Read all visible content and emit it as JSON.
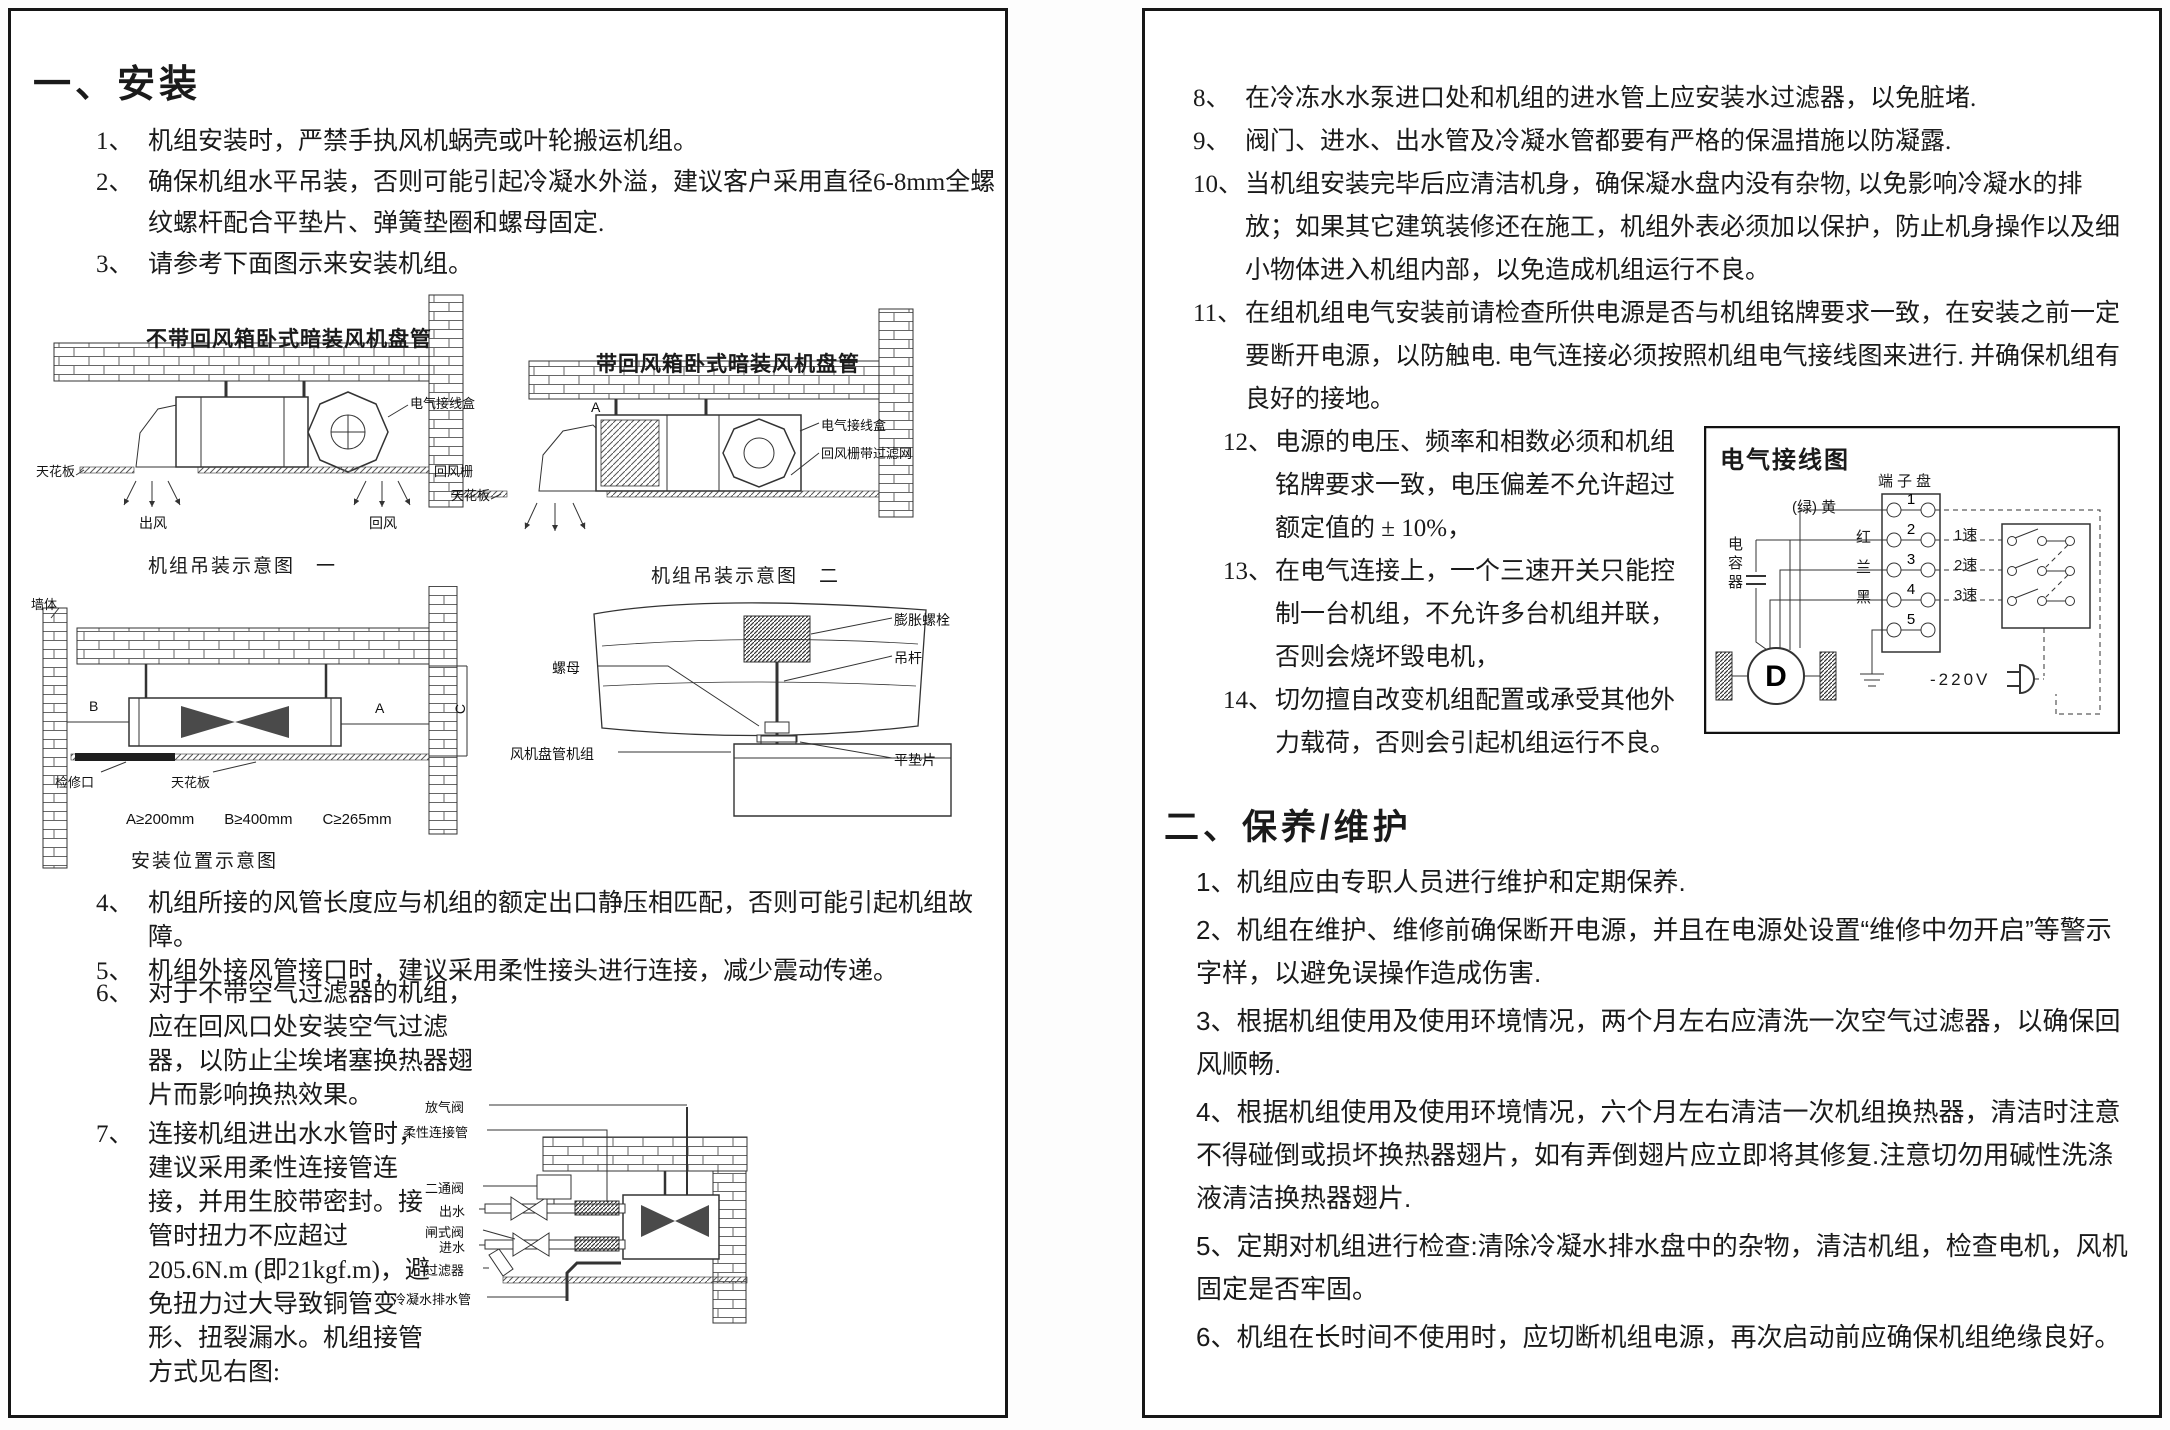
{
  "install": {
    "title": "一、安装",
    "items": [
      {
        "num": "1、",
        "text": "机组安装时，严禁手执风机蜗壳或叶轮搬运机组。"
      },
      {
        "num": "2、",
        "text": "确保机组水平吊装，否则可能引起冷凝水外溢，建议客户采用直径6-8mm全螺纹螺杆配合平垫片、弹簧垫圈和螺母固定."
      },
      {
        "num": "3、",
        "text": "请参考下面图示来安装机组。"
      },
      {
        "num": "4、",
        "text": "机组所接的风管长度应与机组的额定出口静压相匹配，否则可能引起机组故障。"
      },
      {
        "num": "5、",
        "text": "机组外接风管接口时，建议采用柔性接头进行连接，减少震动传递。"
      },
      {
        "num": "6、",
        "text": "对于不带空气过滤器的机组，应在回风口处安装空气过滤器，以防止尘埃堵塞换热器翅片而影响换热效果。"
      },
      {
        "num": "7、",
        "text": "连接机组进出水水管时，建议采用柔性连接管连接，并用生胶带密封。接管时扭力不应超过205.6N.m (即21kgf.m)，避免扭力过大导致铜管变形、扭裂漏水。机组接管方式见右图:"
      }
    ]
  },
  "hang1": {
    "title": "不带回风箱卧式暗装风机盘管",
    "caption": "机组吊装示意图　一",
    "junction_box": "电气接线盒",
    "ceiling": "天花板",
    "return_grille": "回风栅",
    "supply_air": "出风",
    "return_air": "回风"
  },
  "hang2": {
    "title": "带回风箱卧式暗装风机盘管",
    "caption": "机组吊装示意图　二",
    "dim_a": "A",
    "junction_box": "电气接线盒",
    "return_filter": "回风栅带过滤网",
    "ceiling": "天花板"
  },
  "position": {
    "caption": "安装位置示意图",
    "wall": "墙体",
    "dim_a": "A",
    "dim_b": "B",
    "dim_c": "C",
    "access": "检修口",
    "ceiling": "天花板",
    "dims": "A≥200mm　　B≥400mm　　C≥265mm"
  },
  "hanger": {
    "nut": "螺母",
    "unit": "风机盘管机组",
    "anchor_bolt": "膨胀螺栓",
    "rod": "吊杆",
    "washer": "平垫片"
  },
  "piping": {
    "air_vent": "放气阀",
    "flex": "柔性连接管",
    "valve2": "二通阀",
    "out": "出水",
    "gate": "闸式阀",
    "in": "进水",
    "strainer": "过滤器",
    "drain": "冷凝水排水管"
  },
  "install_right": {
    "items": [
      {
        "num": "8、",
        "text": "在冷冻水水泵进口处和机组的进水管上应安装水过滤器，以免脏堵."
      },
      {
        "num": "9、",
        "text": "阀门、进水、出水管及冷凝水管都要有严格的保温措施以防凝露."
      },
      {
        "num": "10、",
        "text": "当机组安装完毕后应清洁机身，确保凝水盘内没有杂物, 以免影响冷凝水的排放；如果其它建筑装修还在施工，机组外表必须加以保护，防止机身操作以及细小物体进入机组内部，以免造成机组运行不良。"
      },
      {
        "num": "11、",
        "text": "在组机组电气安装前请检查所供电源是否与机组铭牌要求一致，在安装之前一定要断开电源，以防触电. 电气连接必须按照机组电气接线图来进行. 并确保机组有良好的接地。"
      },
      {
        "num": "12、",
        "text": "电源的电压、频率和相数必须和机组铭牌要求一致，电压偏差不允许超过额定值的 ± 10%，"
      },
      {
        "num": "13、",
        "text": "在电气连接上，一个三速开关只能控制一台机组，不允许多台机组并联，否则会烧坏毁电机，"
      },
      {
        "num": "14、",
        "text": "切勿擅自改变机组配置或承受其他外力载荷，否则会引起机组运行不良。"
      }
    ]
  },
  "wiring": {
    "title": "电气接线图",
    "terminal_strip": "端子盘",
    "wires": [
      "(绿) 黄",
      "红",
      "兰",
      "黑"
    ],
    "terminals": [
      "1",
      "2",
      "3",
      "4",
      "5"
    ],
    "capacitor": "电容器",
    "motor": "D",
    "speeds": [
      "1速",
      "2速",
      "3速"
    ],
    "power": "-220V"
  },
  "maintenance": {
    "title": "二、保养/维护",
    "items": [
      {
        "num": "1、",
        "text": "机组应由专职人员进行维护和定期保养."
      },
      {
        "num": "2、",
        "text": "机组在维护、维修前确保断开电源，并且在电源处设置“维修中勿开启”等警示字样，以避免误操作造成伤害."
      },
      {
        "num": "3、",
        "text": "根据机组使用及使用环境情况，两个月左右应清洗一次空气过滤器，以确保回风顺畅."
      },
      {
        "num": "4、",
        "text": "根据机组使用及使用环境情况，六个月左右清洁一次机组换热器，清洁时注意不得碰倒或损坏换热器翅片，如有弄倒翅片应立即将其修复.注意切勿用碱性洗涤液清洁换热器翅片."
      },
      {
        "num": "5、",
        "text": "定期对机组进行检查:清除冷凝水排水盘中的杂物，清洁机组，检查电机，风机固定是否牢固。"
      },
      {
        "num": "6、",
        "text": "机组在长时间不使用时，应切断机组电源，再次启动前应确保机组绝缘良好。"
      }
    ]
  }
}
